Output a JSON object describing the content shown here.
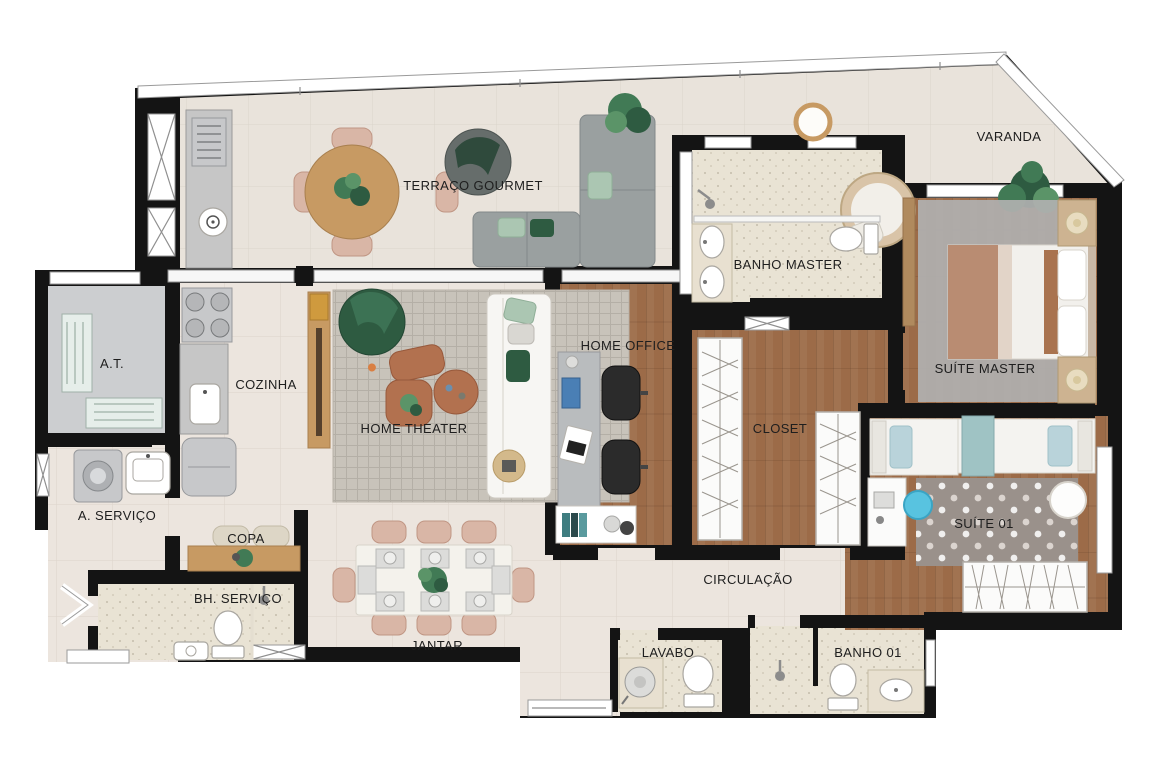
{
  "plan": {
    "type": "apartment-floor-plan",
    "rooms": [
      {
        "id": "terraco-gourmet",
        "label": "TERRAÇO GOURMET"
      },
      {
        "id": "varanda",
        "label": "VARANDA"
      },
      {
        "id": "banho-master",
        "label": "BANHO MASTER"
      },
      {
        "id": "suite-master",
        "label": "SUÍTE MASTER"
      },
      {
        "id": "home-office",
        "label": "HOME OFFICE"
      },
      {
        "id": "closet",
        "label": "CLOSET"
      },
      {
        "id": "at",
        "label": "A.T."
      },
      {
        "id": "cozinha",
        "label": "COZINHA"
      },
      {
        "id": "home-theater",
        "label": "HOME THEATER"
      },
      {
        "id": "a-servico",
        "label": "A. SERVIÇO"
      },
      {
        "id": "copa",
        "label": "COPA"
      },
      {
        "id": "bh-servico",
        "label": "BH. SERVIÇO"
      },
      {
        "id": "jantar",
        "label": "JANTAR"
      },
      {
        "id": "circulacao",
        "label": "CIRCULAÇÃO"
      },
      {
        "id": "lavabo",
        "label": "LAVABO"
      },
      {
        "id": "banho-01",
        "label": "BANHO 01"
      },
      {
        "id": "suite-01",
        "label": "SUÍTE 01"
      }
    ]
  },
  "colors": {
    "wall": "#141414",
    "background": "#ffffff",
    "floorTile": "#ece5de",
    "floorTerrace": "#e9e3db",
    "floorWood": "#9c6b48",
    "floorBath": "#e9e3d4",
    "floorGray": "#ccced0",
    "rugGray": "#b0b0b0",
    "rugDotted": "#9a918b",
    "rugTheater": "#c8c3ba",
    "sofaGray": "#9aa0a0",
    "accentGreen": "#2e5b41",
    "pillowGreen": "#abc6b2",
    "terracotta": "#b2714f",
    "woodFurniture": "#c79a63",
    "chairBlush": "#d9b6a6",
    "furnitureWhite": "#f7f6f3",
    "chairBlue": "#58c3e0",
    "pillowBlue": "#b9d3da",
    "labelColor": "#1e1e1e"
  }
}
